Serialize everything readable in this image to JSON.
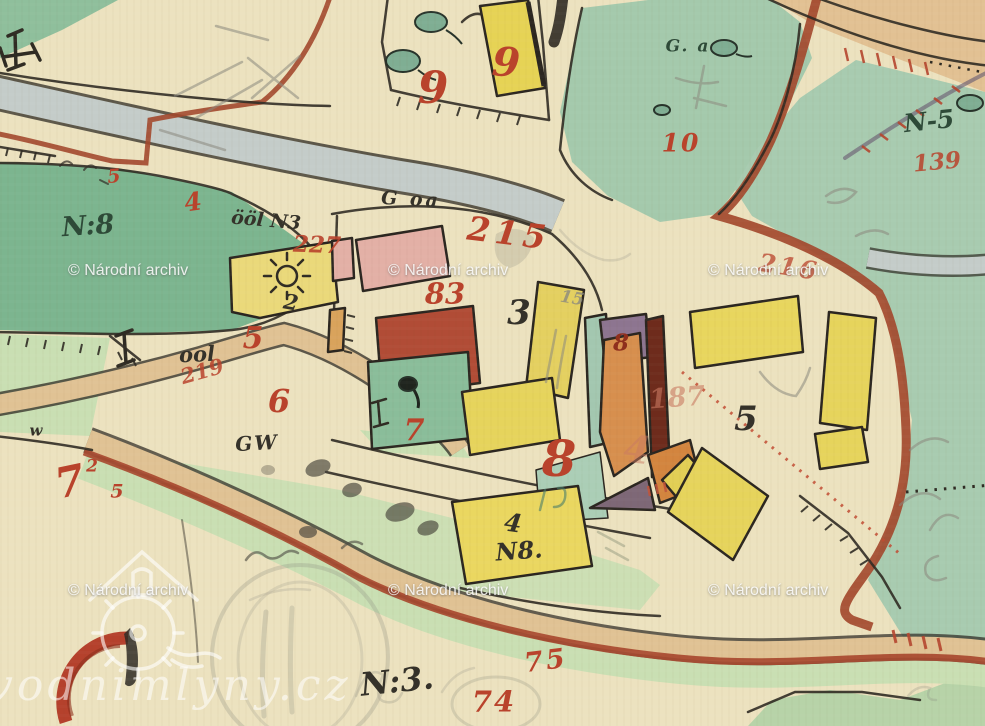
{
  "map": {
    "title": "historic hand-drawn cadastral map sheet",
    "ink_colors": {
      "red": "#b9432c",
      "dark": "#35322a",
      "green_dark": "#2e4a38",
      "pencil": "#8b897f",
      "dark_red": "#8f2f1d",
      "faded_red": "#c97a62"
    },
    "palette": {
      "parchment": "#ece2bf",
      "meadow_dark": "#7cb58f",
      "meadow_mid": "#a4c9ac",
      "meadow_light": "#c9dfb3",
      "road_grey": "#c4ccc9",
      "road_tan": "#e0c294",
      "road_red": "#a3492e",
      "building_yellow": "#e6d355",
      "building_pink": "#e3b0a6",
      "building_red": "#b14c36",
      "building_orange": "#d78f4e",
      "building_plum": "#8d7590",
      "ink": "#2f2b23"
    },
    "labels": [
      {
        "name": "no8-left",
        "text": "N:8",
        "x": 88,
        "y": 226,
        "size": 27,
        "color": "green_dark",
        "rot": -4
      },
      {
        "name": "ool-n3",
        "text": "ööl N3",
        "x": 266,
        "y": 221,
        "size": 19,
        "color": "dark",
        "rot": 5
      },
      {
        "name": "ool",
        "text": "ool",
        "x": 197,
        "y": 354,
        "size": 21,
        "color": "dark",
        "rot": -3
      },
      {
        "name": "g-oa",
        "text": "G oa",
        "x": 411,
        "y": 200,
        "size": 19,
        "color": "dark",
        "rot": 3,
        "ls": 3
      },
      {
        "name": "house-3",
        "text": "3",
        "x": 519,
        "y": 313,
        "size": 34,
        "color": "dark"
      },
      {
        "name": "g-a",
        "text": "G. a",
        "x": 688,
        "y": 47,
        "size": 17,
        "color": "green_dark",
        "ls": 2
      },
      {
        "name": "n-5",
        "text": "N-5",
        "x": 929,
        "y": 121,
        "size": 25,
        "color": "green_dark",
        "rot": -6
      },
      {
        "name": "house-5",
        "text": "5",
        "x": 746,
        "y": 419,
        "size": 34,
        "color": "dark"
      },
      {
        "name": "no8-4",
        "text": "4",
        "x": 513,
        "y": 523,
        "size": 25,
        "color": "dark",
        "rot": 8
      },
      {
        "name": "no8-label",
        "text": "N8.",
        "x": 519,
        "y": 551,
        "size": 24,
        "color": "dark",
        "rot": -4
      },
      {
        "name": "gw",
        "text": "GW",
        "x": 257,
        "y": 443,
        "size": 20,
        "color": "dark",
        "rot": -3,
        "ls": 2
      },
      {
        "name": "w",
        "text": "w",
        "x": 36,
        "y": 431,
        "size": 15,
        "color": "dark"
      },
      {
        "name": "no3",
        "text": "N:3.",
        "x": 397,
        "y": 681,
        "size": 32,
        "color": "dark",
        "rot": -6
      },
      {
        "name": "wheel-2",
        "text": "2",
        "x": 291,
        "y": 302,
        "size": 21,
        "color": "dark",
        "rot": 10
      },
      {
        "name": "pencil-15",
        "text": "15",
        "x": 572,
        "y": 299,
        "size": 17,
        "color": "pencil",
        "rot": 10,
        "op": 0.8
      },
      {
        "name": "parcel-9",
        "text": "9",
        "x": 433,
        "y": 89,
        "size": 44,
        "color": "red"
      },
      {
        "name": "house-9",
        "text": "9",
        "x": 506,
        "y": 63,
        "size": 40,
        "color": "red",
        "rot": 4
      },
      {
        "name": "parcel-10",
        "text": "10",
        "x": 681,
        "y": 143,
        "size": 25,
        "color": "red",
        "ls": 2
      },
      {
        "name": "parcel-139",
        "text": "139",
        "x": 937,
        "y": 162,
        "size": 23,
        "color": "red",
        "rot": -5,
        "op": 0.85
      },
      {
        "name": "red-4-left",
        "text": "4",
        "x": 193,
        "y": 202,
        "size": 25,
        "color": "red",
        "rot": -8
      },
      {
        "name": "parcel-227",
        "text": "227",
        "x": 317,
        "y": 245,
        "size": 23,
        "color": "red",
        "rot": 2,
        "op": 0.9
      },
      {
        "name": "parcel-215",
        "text": "215",
        "x": 509,
        "y": 233,
        "size": 33,
        "color": "red",
        "rot": 7,
        "ls": 5
      },
      {
        "name": "parcel-216",
        "text": "216",
        "x": 789,
        "y": 267,
        "size": 25,
        "color": "red",
        "rot": 9,
        "op": 0.75,
        "ls": 3
      },
      {
        "name": "parcel-83",
        "text": "83",
        "x": 445,
        "y": 294,
        "size": 29,
        "color": "red"
      },
      {
        "name": "red-5-mid",
        "text": "5",
        "x": 253,
        "y": 339,
        "size": 30,
        "color": "red"
      },
      {
        "name": "parcel-219",
        "text": "219",
        "x": 202,
        "y": 371,
        "size": 21,
        "color": "red",
        "rot": -16,
        "op": 0.85
      },
      {
        "name": "parcel-6",
        "text": "6",
        "x": 279,
        "y": 401,
        "size": 32,
        "color": "red"
      },
      {
        "name": "parcel-7-green",
        "text": "7",
        "x": 414,
        "y": 431,
        "size": 30,
        "color": "red"
      },
      {
        "name": "house-8-dark",
        "text": "8",
        "x": 621,
        "y": 343,
        "size": 23,
        "color": "dark_red"
      },
      {
        "name": "parcel-187",
        "text": "187",
        "x": 677,
        "y": 398,
        "size": 27,
        "color": "faded_red",
        "op": 0.6,
        "rot": -4
      },
      {
        "name": "big-8",
        "text": "8",
        "x": 559,
        "y": 459,
        "size": 50,
        "color": "red"
      },
      {
        "name": "faded-4",
        "text": "4",
        "x": 637,
        "y": 450,
        "size": 38,
        "color": "faded_red",
        "op": 0.5,
        "rot": 6
      },
      {
        "name": "parcel-7-bl",
        "text": "7",
        "x": 70,
        "y": 482,
        "size": 42,
        "color": "red",
        "rot": -12
      },
      {
        "name": "parcel-7-sup2",
        "text": "2",
        "x": 92,
        "y": 467,
        "size": 17,
        "color": "red"
      },
      {
        "name": "parcel-7-sup5",
        "text": "5",
        "x": 117,
        "y": 492,
        "size": 19,
        "color": "red"
      },
      {
        "name": "parcel-75",
        "text": "75",
        "x": 546,
        "y": 661,
        "size": 27,
        "color": "red",
        "rot": -7,
        "ls": 3
      },
      {
        "name": "parcel-74",
        "text": "74",
        "x": 494,
        "y": 702,
        "size": 29,
        "color": "red",
        "ls": 2
      },
      {
        "name": "red-5-left",
        "text": "5",
        "x": 114,
        "y": 177,
        "size": 19,
        "color": "red",
        "rot": -5
      }
    ]
  },
  "watermarks": {
    "archive": {
      "text": "© Národní archiv",
      "positions": [
        {
          "x": 68,
          "y": 262
        },
        {
          "x": 388,
          "y": 262
        },
        {
          "x": 708,
          "y": 262
        },
        {
          "x": 68,
          "y": 582
        },
        {
          "x": 388,
          "y": 582
        },
        {
          "x": 708,
          "y": 582
        }
      ]
    },
    "site": {
      "text": "vodnimlyny.cz"
    }
  }
}
